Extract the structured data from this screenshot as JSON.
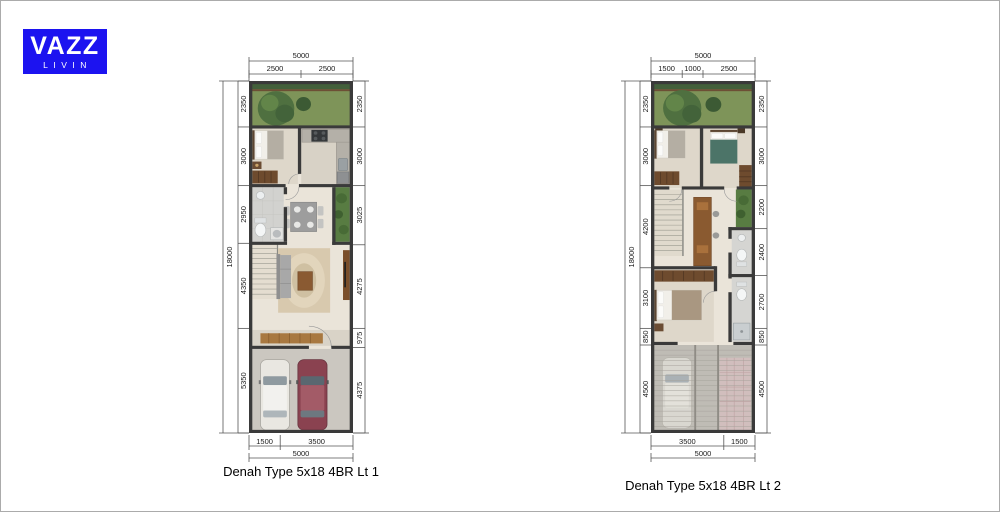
{
  "page": {
    "background": "#ffffff",
    "border_color": "#ababab"
  },
  "logo": {
    "text_primary": "VAZZ",
    "text_secondary": "LIVIN",
    "bg_color": "#1c13f0",
    "text_color": "#ffffff"
  },
  "palette": {
    "wall": "#3a3a3a",
    "floor": "#eae4d9",
    "garden_green": "#7e9459",
    "dim_line": "#555555",
    "dim_text": "#1a1a1a",
    "car_white": "#e9e7e1",
    "car_red": "#8a4250"
  },
  "plans": [
    {
      "caption": "Denah Type 5x18 4BR Lt 1",
      "dims": {
        "top_total": "5000",
        "top_segments": [
          "2500",
          "2500"
        ],
        "bottom_total": "5000",
        "bottom_segments": [
          "1500",
          "3500"
        ],
        "left_total": "18000",
        "left_segments": [
          "2350",
          "3000",
          "2950",
          "4350",
          "5350"
        ],
        "right_segments": [
          "2350",
          "3000",
          "3025",
          "4275",
          "975",
          "4375"
        ]
      }
    },
    {
      "caption": "Denah Type 5x18 4BR Lt 2",
      "dims": {
        "top_total": "5000",
        "top_segments": [
          "1500",
          "1000",
          "2500"
        ],
        "bottom_total": "5000",
        "bottom_segments": [
          "3500",
          "1500"
        ],
        "left_total": "18000",
        "left_segments": [
          "2350",
          "3000",
          "4200",
          "3100",
          "850",
          "4500"
        ],
        "right_segments": [
          "2350",
          "3000",
          "2200",
          "2400",
          "2700",
          "850",
          "4500"
        ]
      }
    }
  ]
}
